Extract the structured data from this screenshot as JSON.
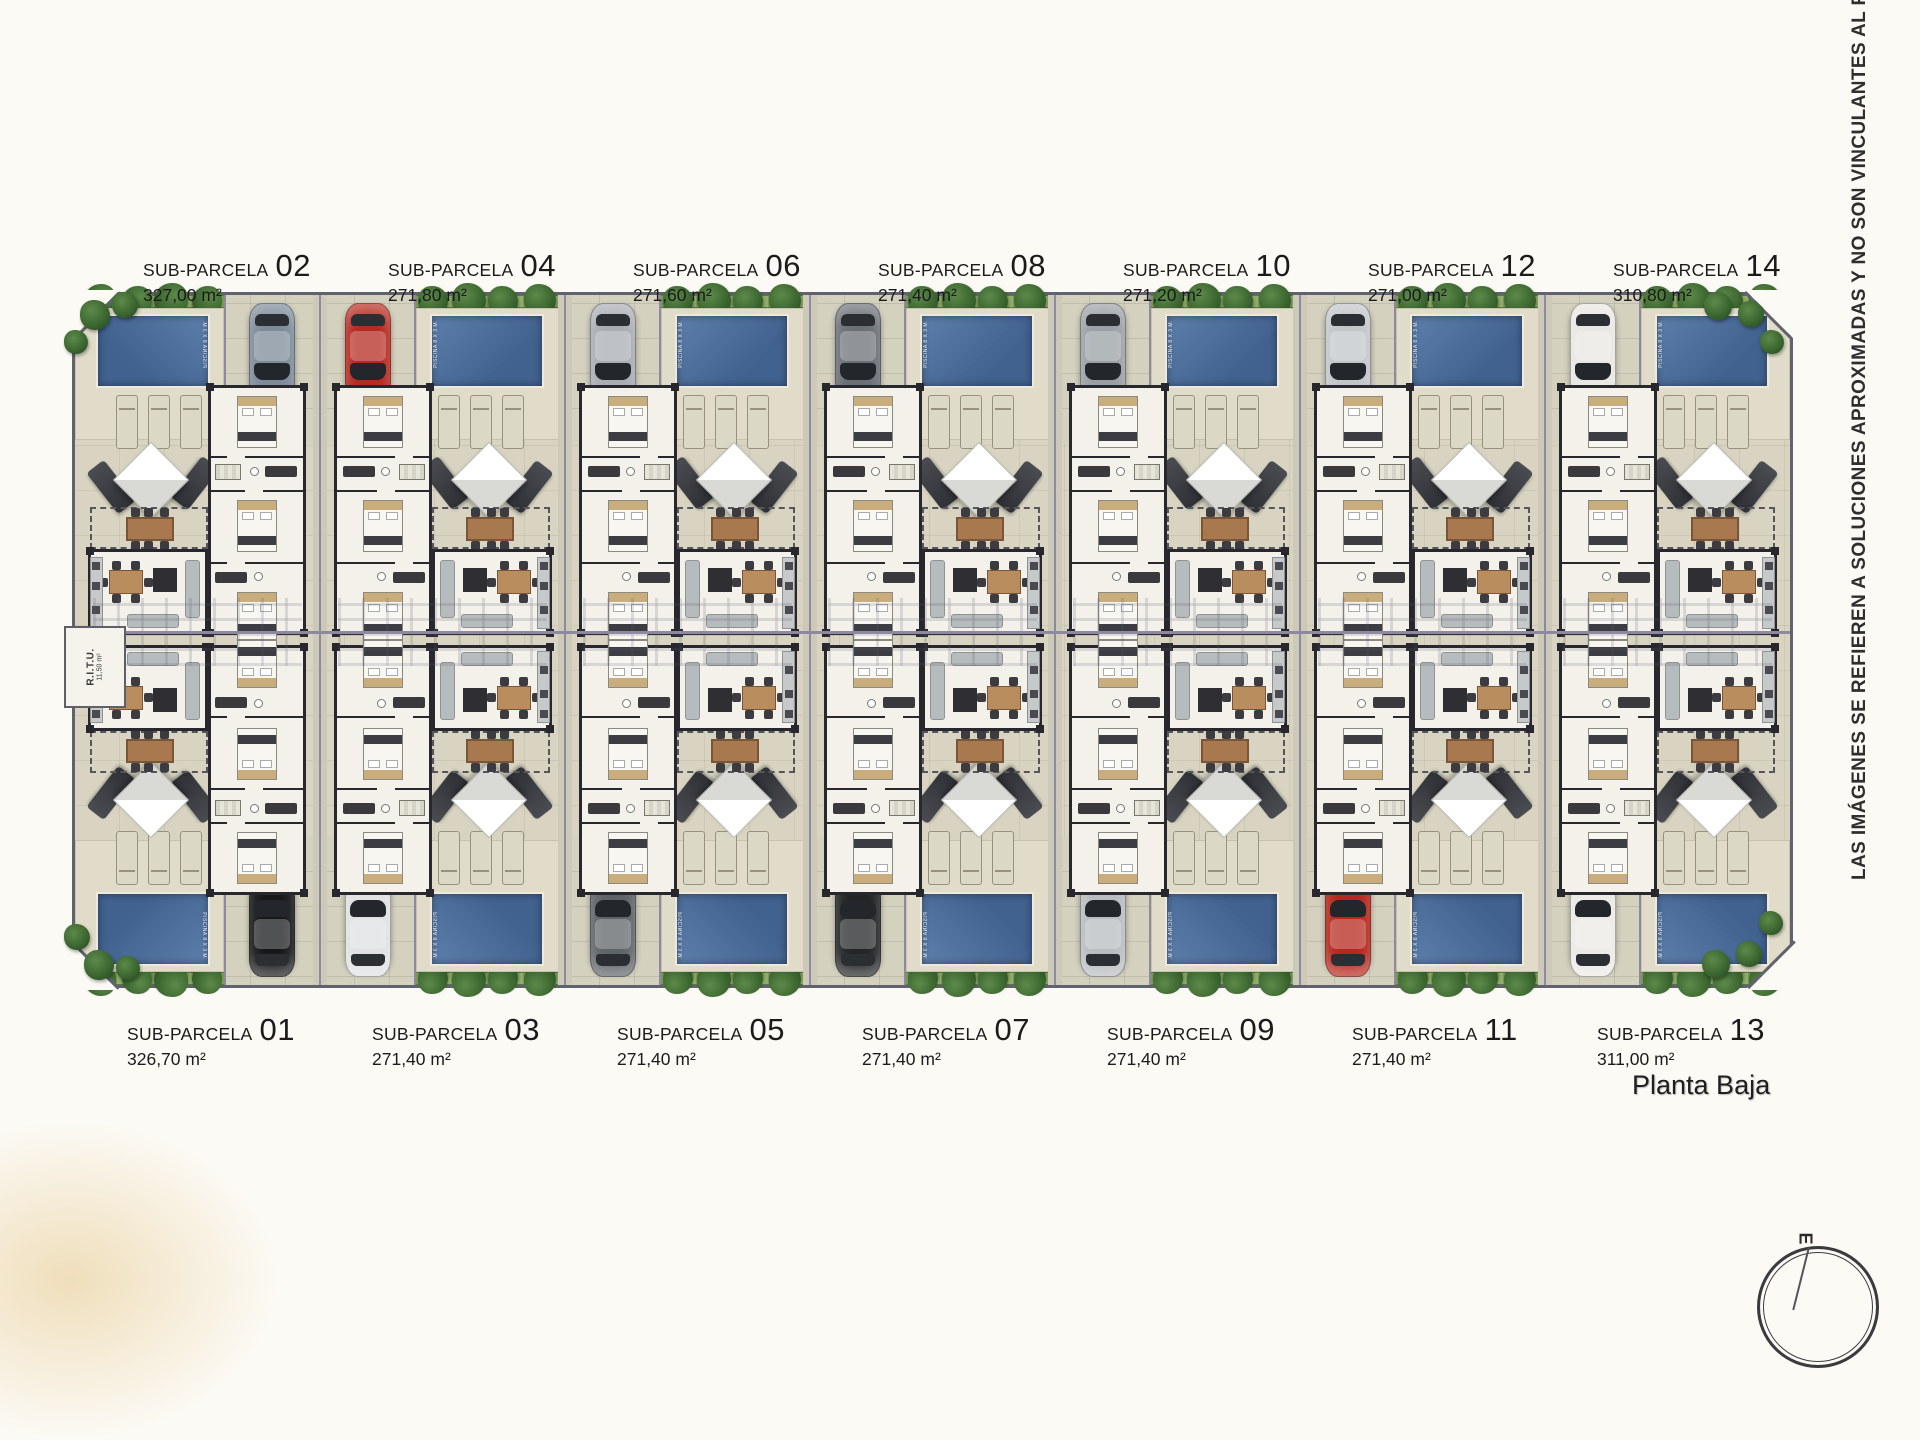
{
  "page": {
    "disclaimer": "LAS IMÁGENES SE REFIEREN A SOLUCIONES APROXIMADAS Y NO SON VINCULANTES AL PROYECTO",
    "plan_title": "Planta Baja"
  },
  "compass": {
    "east_label": "E"
  },
  "site": {
    "label_prefix": "SUB-PARCELA",
    "pool_label": "PISCINA 8 X 3 M.",
    "utility_room": {
      "label": "R.I.T.U.",
      "area": "11,50 m²"
    },
    "colors": {
      "ground": "#d8d4c1",
      "pool": "#4f719f",
      "hedge": "#93b06c",
      "wall": "#27272d",
      "path": "#8f89a0",
      "accent_red_car": "#b52b20"
    }
  },
  "parcels": {
    "top": [
      {
        "number": "02",
        "area": "327,00 m²",
        "pool_side": "left",
        "car_color": "#7d8b99"
      },
      {
        "number": "04",
        "area": "271,80 m²",
        "pool_side": "right",
        "car_color": "#b52b20"
      },
      {
        "number": "06",
        "area": "271,60 m²",
        "pool_side": "right",
        "car_color": "#a9adb3"
      },
      {
        "number": "08",
        "area": "271,40 m²",
        "pool_side": "right",
        "car_color": "#6b7076"
      },
      {
        "number": "10",
        "area": "271,20 m²",
        "pool_side": "right",
        "car_color": "#9aa0a5"
      },
      {
        "number": "12",
        "area": "271,00 m²",
        "pool_side": "right",
        "car_color": "#c2c6c9"
      },
      {
        "number": "14",
        "area": "310,80 m²",
        "pool_side": "right",
        "car_color": "#e9e7e3"
      }
    ],
    "bottom": [
      {
        "number": "01",
        "area": "326,70 m²",
        "pool_side": "left",
        "car_color": "#17181a"
      },
      {
        "number": "03",
        "area": "271,40 m²",
        "pool_side": "right",
        "car_color": "#dfe1e2"
      },
      {
        "number": "05",
        "area": "271,40 m²",
        "pool_side": "right",
        "car_color": "#5f6468"
      },
      {
        "number": "07",
        "area": "271,40 m²",
        "pool_side": "right",
        "car_color": "#232527"
      },
      {
        "number": "09",
        "area": "271,40 m²",
        "pool_side": "right",
        "car_color": "#b9bdc1"
      },
      {
        "number": "11",
        "area": "271,40 m²",
        "pool_side": "right",
        "car_color": "#b6271c"
      },
      {
        "number": "13",
        "area": "311,00 m²",
        "pool_side": "right",
        "car_color": "#eceae6"
      }
    ]
  }
}
